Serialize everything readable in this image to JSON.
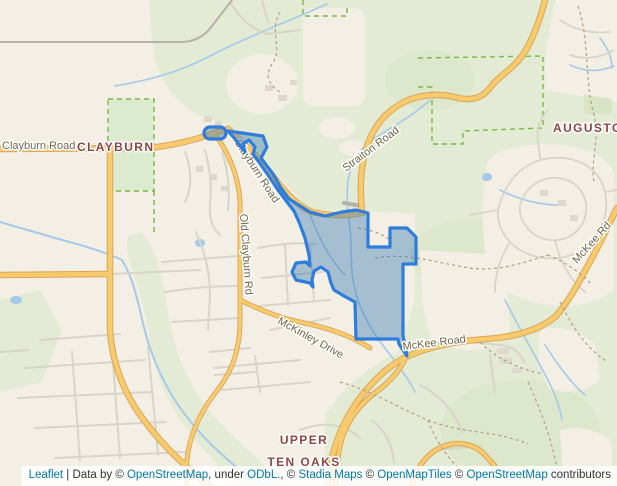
{
  "labels": {
    "clayburn_road": "Clayburn Road",
    "clayburn_place": "CLAYBURN",
    "clayburn_road_creek": "Clayburn Road",
    "straiton_road": "Straiton Road",
    "auguston_place": "AUGUSTON",
    "old_clayburn_rd": "Old Clayburn Rd",
    "mckinley_drive": "McKinley Drive",
    "mckee_road": "McKee Road",
    "mckee_rd_upper": "McKee Rd",
    "upper_ten_oaks_line1": "UPPER",
    "upper_ten_oaks_line2": "TEN OAKS"
  },
  "attribution": {
    "parts": [
      {
        "text": "Leaflet",
        "link": true,
        "name": "leaflet-link"
      },
      {
        "text": " | Data by © ",
        "link": false,
        "name": "attribution-text"
      },
      {
        "text": "OpenStreetMap",
        "link": true,
        "name": "openstreetmap-link"
      },
      {
        "text": ", under ",
        "link": false,
        "name": "attribution-text"
      },
      {
        "text": "ODbL.",
        "link": true,
        "name": "odbl-link"
      },
      {
        "text": ", © ",
        "link": false,
        "name": "attribution-text"
      },
      {
        "text": "Stadia Maps",
        "link": true,
        "name": "stadia-maps-link"
      },
      {
        "text": " © ",
        "link": false,
        "name": "attribution-text"
      },
      {
        "text": "OpenMapTiles",
        "link": true,
        "name": "openmaptiles-link"
      },
      {
        "text": " © ",
        "link": false,
        "name": "attribution-text"
      },
      {
        "text": "OpenStreetMap",
        "link": true,
        "name": "openstreetmap-link-2"
      },
      {
        "text": " contributors",
        "link": false,
        "name": "attribution-text"
      }
    ]
  },
  "colors": {
    "land": "#f3efe4",
    "forest": "#e3ebd5",
    "forest_dark": "#d8e4c4",
    "park_fill": "#dcead0",
    "park_border": "#76b843",
    "water": "#a4c9e9",
    "road_orange_fill": "#f8ca6e",
    "road_orange_casing": "#d9a658",
    "road_minor": "#d8d4c8",
    "road_gray": "#b5b2a8",
    "building": "#ddd8cb",
    "trail": "#b49c80",
    "boundary_stroke": "#2e7ddb",
    "boundary_fill": "rgba(58,125,180,0.42)",
    "road_label": "#6f6545",
    "road_label_gray": "#6e6b58",
    "place_label": "#8d4545",
    "attribution_text": "#333333",
    "attribution_link": "#0078a8"
  }
}
